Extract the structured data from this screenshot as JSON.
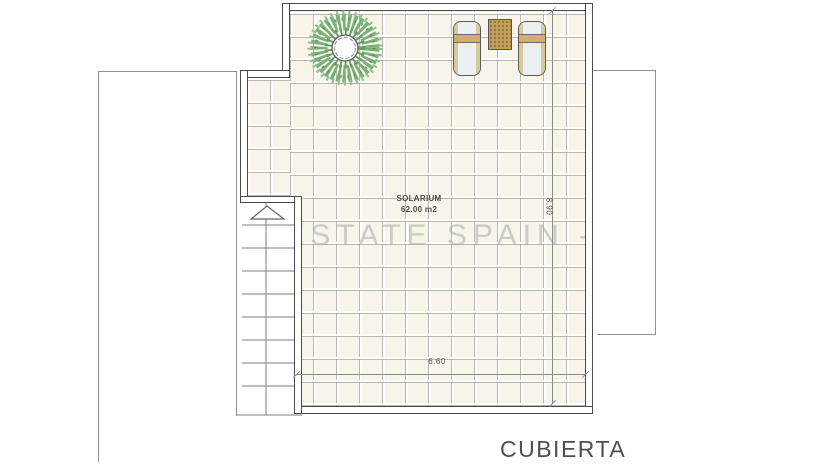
{
  "plan": {
    "title": "CUBIERTA",
    "room": {
      "name": "SOLARIUM",
      "area": "62.00 m2"
    },
    "dimensions": {
      "width": "6.60",
      "height": "8.90"
    },
    "watermark": "- ESTATE SPAIN -",
    "icons": {
      "tree": "tree-plan-view",
      "lounger_left": "sun-lounger",
      "lounger_right": "sun-lounger",
      "table": "side-table",
      "stairs": "staircase-with-up-arrow"
    },
    "colors": {
      "wall": "#4b4b4b",
      "outline": "#8f8f8c",
      "tile_background": "#f8f4ea",
      "tile_grid": "#94908a",
      "foliage_green": "#79af79",
      "wood_tan": "#c7a05f",
      "lounger_body": "#eaeff2",
      "watermark_gray": "#a8a8a4",
      "label_text": "#4f4f4f"
    }
  }
}
